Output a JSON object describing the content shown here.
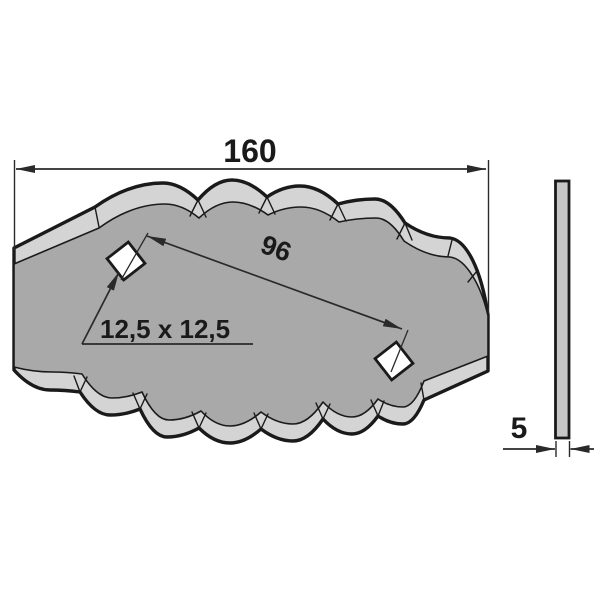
{
  "drawing": {
    "type": "technical-drawing",
    "views": {
      "front_view": {
        "shape": "wavy-scalloped-blade",
        "holes_count": 2,
        "hole_shape": "square-rotated-45",
        "width_dimension": {
          "label": "160"
        },
        "hole_spacing_dimension": {
          "label": "96"
        },
        "hole_size_dimension": {
          "label": "12,5 x 12,5"
        }
      },
      "side_view": {
        "shape": "thin-plate",
        "thickness_dimension": {
          "label": "5"
        }
      }
    }
  },
  "colors": {
    "background": "#ffffff",
    "outline": "#1a1a1a",
    "bevel": "#d4d4d4",
    "face": "#a9a9a9",
    "side": "#c6c6c6",
    "hole": "#ffffff",
    "dimension": "#2a2a2a",
    "text": "#1a1a1a"
  }
}
